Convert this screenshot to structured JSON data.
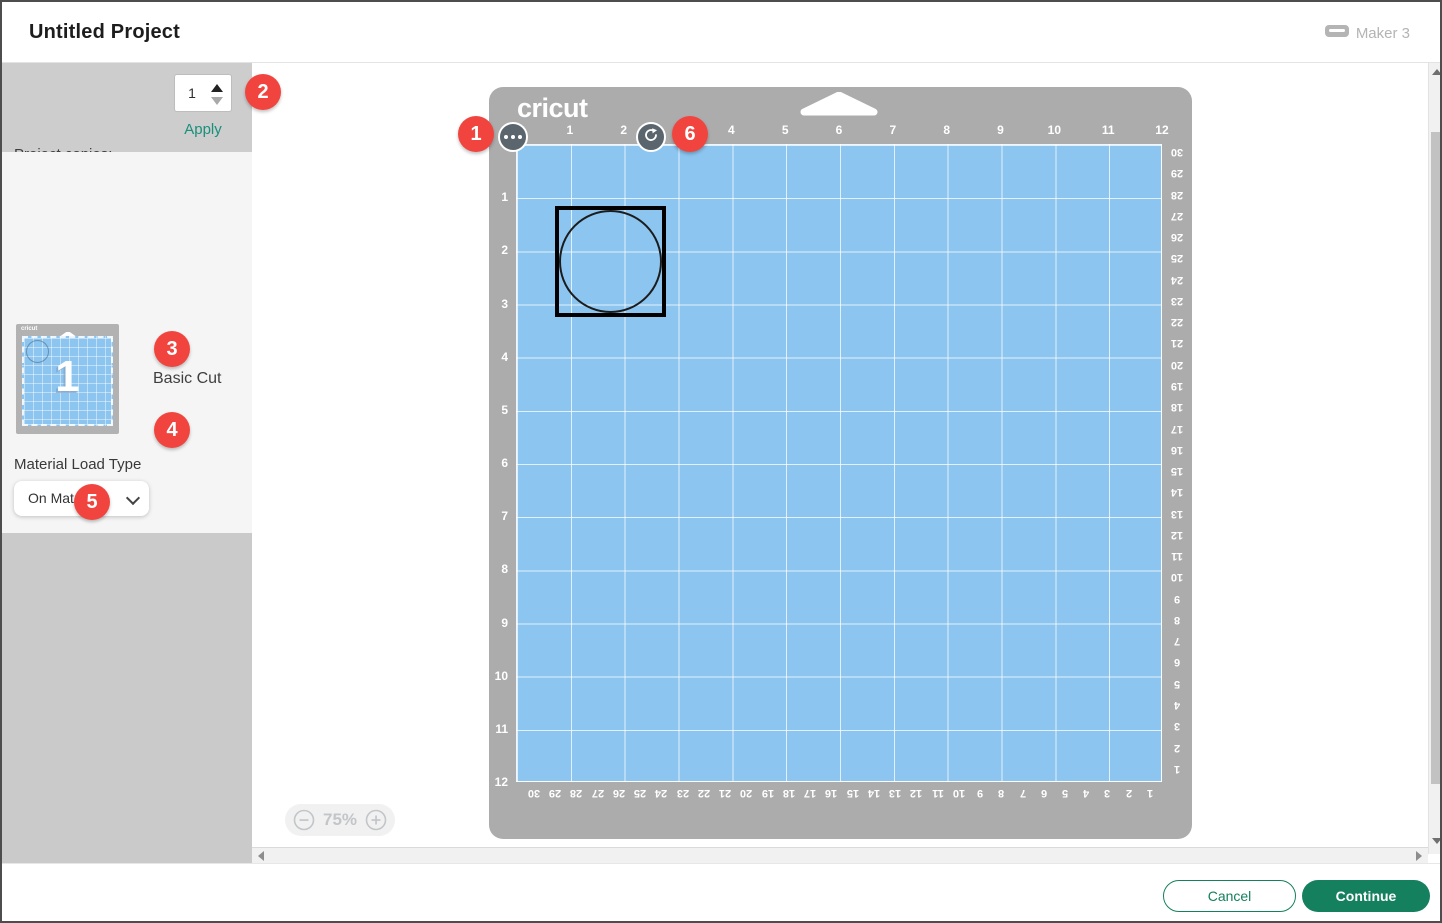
{
  "header": {
    "title": "Untitled Project",
    "machine": "Maker 3"
  },
  "sidebar": {
    "project_copies_label": "Project copies:",
    "project_copies_value": "1",
    "apply_label": "Apply",
    "thumb_number": "1",
    "line_type": "Basic Cut",
    "material_load_type_label": "Material Load Type",
    "material_load_type_value": "On Mat",
    "material_size_label": "Material Size",
    "material_size_value": "12 in x 12 in",
    "mirror_label": "Mirror"
  },
  "mat": {
    "brand": "cricut",
    "top_numbers": [
      "1",
      "2",
      "3",
      "4",
      "5",
      "6",
      "7",
      "8",
      "9",
      "10",
      "11",
      "12"
    ],
    "left_numbers": [
      "1",
      "2",
      "3",
      "4",
      "5",
      "6",
      "7",
      "8",
      "9",
      "10",
      "11",
      "12"
    ],
    "right_numbers": [
      "30",
      "29",
      "28",
      "27",
      "26",
      "25",
      "24",
      "23",
      "22",
      "21",
      "20",
      "19",
      "18",
      "17",
      "16",
      "15",
      "14",
      "13",
      "12",
      "11",
      "10",
      "9",
      "8",
      "7",
      "6",
      "5",
      "4",
      "3",
      "2",
      "1"
    ],
    "bottom_numbers": [
      "30",
      "29",
      "28",
      "27",
      "26",
      "25",
      "24",
      "23",
      "22",
      "21",
      "20",
      "19",
      "18",
      "17",
      "16",
      "15",
      "14",
      "13",
      "12",
      "11",
      "10",
      "9",
      "8",
      "7",
      "6",
      "5",
      "4",
      "3",
      "2",
      "1"
    ]
  },
  "zoom_control": {
    "value": "75%"
  },
  "footer": {
    "cancel": "Cancel",
    "continue": "Continue"
  },
  "callouts": [
    {
      "n": "1",
      "x": 456,
      "y": 114
    },
    {
      "n": "2",
      "x": 243,
      "y": 72
    },
    {
      "n": "3",
      "x": 152,
      "y": 329
    },
    {
      "n": "4",
      "x": 152,
      "y": 410
    },
    {
      "n": "5",
      "x": 72,
      "y": 482
    },
    {
      "n": "6",
      "x": 670,
      "y": 114
    }
  ],
  "colors": {
    "badge_red": "#f2443e",
    "button_green": "#15805e",
    "apply_teal": "#18907a",
    "mat_gray": "#acacac",
    "mat_blue": "#8cc5ef"
  }
}
